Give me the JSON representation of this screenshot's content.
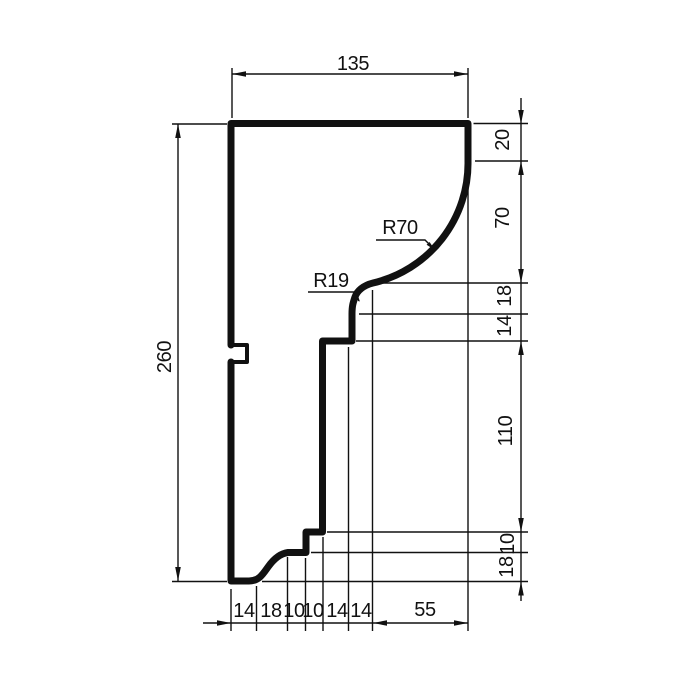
{
  "drawing_title": "molding-profile-section",
  "colors": {
    "line": "#111111",
    "background": "#ffffff"
  },
  "dims": {
    "top": "135",
    "left": "260",
    "right": [
      "20",
      "70",
      "18",
      "14",
      "110",
      "10",
      "18"
    ],
    "bottom": [
      "14",
      "18",
      "10",
      "10",
      "14",
      "14",
      "55"
    ]
  },
  "radii": {
    "r70": "R70",
    "r19": "R19"
  }
}
